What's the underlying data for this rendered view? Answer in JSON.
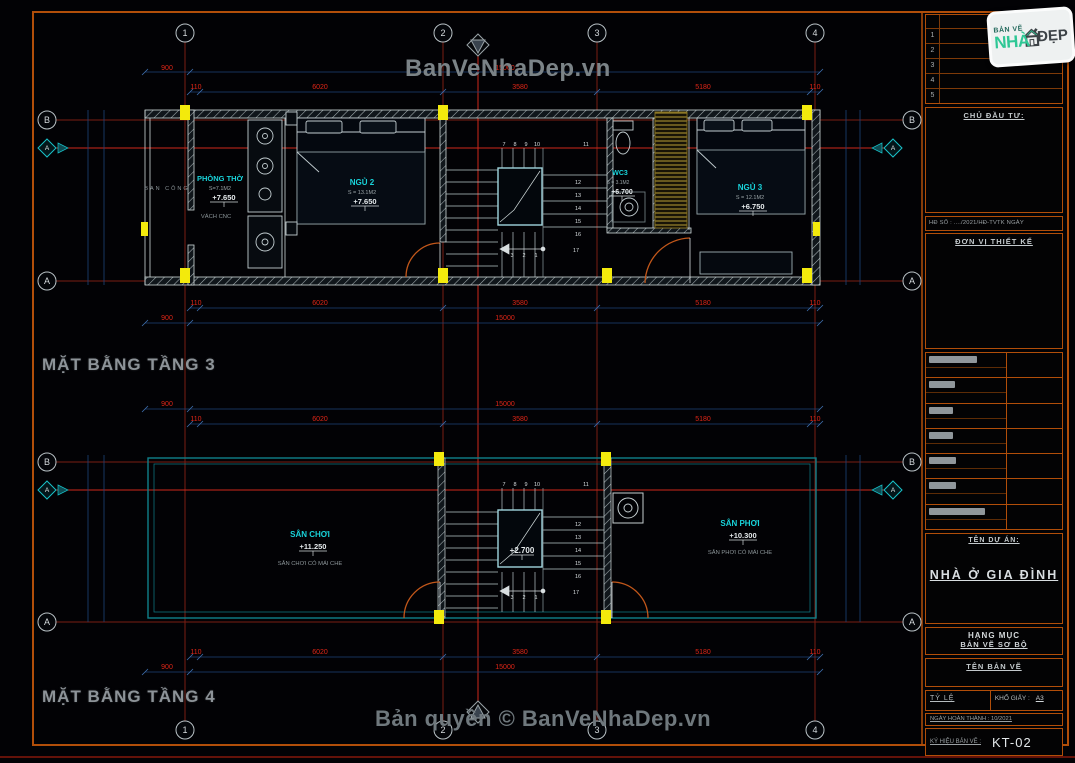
{
  "watermarks": {
    "top": "BanVeNhaDep.vn",
    "bottom": "Bản quyền © BanVeNhaDep.vn"
  },
  "plans": {
    "floor3": {
      "title": "MẶT BẰNG TẦNG 3",
      "balcony": "BAN CÔNG",
      "wall_note": "VÁCH CNC",
      "rooms": {
        "tho": {
          "name": "PHÒNG THỜ",
          "area": "S=7.1M2",
          "level": "+7.650"
        },
        "ngu2": {
          "name": "NGỦ 2",
          "area": "S = 13.1M2",
          "level": "+7.650"
        },
        "wc3": {
          "name": "WC3",
          "area": "S = 3.1M2",
          "level": "+6.700"
        },
        "ngu3": {
          "name": "NGỦ 3",
          "area": "S = 12.1M2",
          "level": "+6.750"
        }
      }
    },
    "floor4": {
      "title": "MẶT BẰNG TẦNG 4",
      "stair_level": "+2.700",
      "rooms": {
        "choi": {
          "name": "SÂN CHƠI",
          "level": "+11.250",
          "note": "SÂN CHƠI CÓ MÁI CHE"
        },
        "phoi": {
          "name": "SÂN PHƠI",
          "level": "+10.300",
          "note": "SÂN PHƠI CÓ MÁI CHE"
        }
      }
    }
  },
  "dims": {
    "b900": "900",
    "t110": "110",
    "s1": "6020",
    "s2": "3580",
    "s3": "5180",
    "total": "15000"
  },
  "grid": {
    "c1": "1",
    "c2": "2",
    "c3": "3",
    "c4": "4",
    "rA": "A",
    "rB": "B",
    "section": "A"
  },
  "stairs": {
    "n1": "1",
    "n2": "2",
    "n3": "3",
    "n7": "7",
    "n8": "8",
    "n9": "9",
    "n10": "10",
    "n11": "11",
    "n12": "12",
    "n13": "13",
    "n14": "14",
    "n15": "15",
    "n16": "16",
    "n17": "17"
  },
  "titleblock": {
    "revisions": [
      "1",
      "2",
      "3",
      "4",
      "5"
    ],
    "chu_dau_tu": "CHỦ ĐẦU TƯ:",
    "ho_so": "HĐ SỐ : ..../2021/HĐ-TVTK NGÀY",
    "don_vi": "ĐƠN VỊ THIẾT KẾ",
    "ten_du_an_label": "TÊN DỰ ÁN:",
    "ten_du_an": "NHÀ Ở GIA ĐÌNH",
    "hang_muc_label": "HẠNG MỤC",
    "hang_muc": "BẢN VẼ SƠ BỘ",
    "ten_ban_ve_label": "TÊN BẢN VẼ",
    "ty_le": "TỶ LỆ",
    "kho_giay_label": "KHỔ GIẤY :",
    "kho_giay_value": "A3",
    "ngay": "NGÀY HOÀN THÀNH : 10/2021",
    "ky_hieu_label": "KÝ HIỆU BẢN VẼ :",
    "ky_hieu": "KT-02",
    "logo": {
      "top": "BẢN VẼ",
      "mid": "NHÀ",
      "right": "ĐẸP"
    }
  }
}
